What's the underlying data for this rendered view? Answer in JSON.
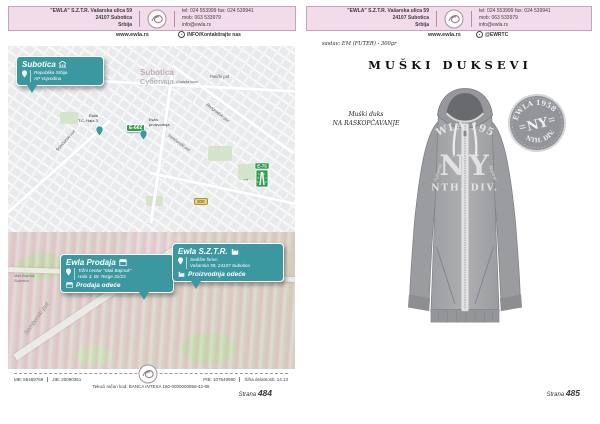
{
  "colors": {
    "header_pink": "#f3dcea",
    "card_teal": "#3b98a1",
    "route_green": "#2e9e4f",
    "route_yellow": "#ecd27a"
  },
  "header": {
    "company_line1": "\"EWLA\" S.Z.T.R. Vašarska ulica 59",
    "company_line2": "24107 Subotica",
    "company_line3": "Srbija",
    "contact_line1": "tel: 024 553999  fax: 024 539941",
    "contact_line2": "mob: 063 533979",
    "contact_line3": "info@ewla.rs",
    "website": "www.ewla.rs",
    "info_link": "INFO/Kontaktirajte nas",
    "social_handle": "@EWRTC"
  },
  "map": {
    "city_card": {
      "title": "Subotica",
      "region_line1": "Republika Srbija",
      "region_line2": "AP Vojvodina"
    },
    "city_latin": "Subotica",
    "city_cyrillic": "Суботица",
    "poi_center": "Gradska kuća",
    "road_palicki": "Palićki put",
    "road_beogradski": "Beogradski put",
    "road_sencanski": "Senćanski put",
    "road_somborski": "Somborski put",
    "badge_e662": "E-662",
    "badge_300": "300",
    "badge_e75": "E-75",
    "marker_prod_line1": "Ewla",
    "marker_prod_line2": "T.C. Hala 3",
    "marker_factory_line1": "Ewla",
    "marker_factory_line2": "proizvodnja",
    "district_line1": "Mali Bajmok",
    "district_line2": "Subotica",
    "aerial_road": "Somborski put"
  },
  "cards": {
    "prodaja": {
      "title": "Ewla Prodaja",
      "addr_line1": "Tržni centar \"Mali Bajmok\"",
      "addr_line2": "Hala 3, Bc Tezge 31/23",
      "tag": "Prodaja odeće"
    },
    "sztr": {
      "title": "Ewla S.Z.T.R.",
      "addr_line1": "Sedište firme:",
      "addr_line2": "Vašarska 59, 24107 Subotica",
      "tag": "Proizvodnja odeće"
    }
  },
  "footer": {
    "mb": "MB: 55469769",
    "jib": "JIB: 20090351",
    "pib": "PIB: 107549990",
    "activity": "Šifra delatnosti: 14.13",
    "bank_account": "Tekući račun kod: BANCA INTESA 160-0000000956-42-86",
    "page_word": "Strana",
    "left_page_number": "484",
    "right_page_number": "485"
  },
  "product": {
    "material_note": "sastav: EM (FUTER) - 300gr",
    "title": "MUŠKI DUKSEVI",
    "label_line1": "Muški duks",
    "label_line2": "NA RASKOPČAVANJE",
    "print_arc": "EWLA 1958",
    "print_left": "N",
    "print_right": "Y",
    "print_script_left": "Authentic",
    "print_script_right": "Apparel",
    "print_bottom": "NTH. DIV.",
    "badge_arc_top": "EWLA 1958",
    "badge_center": "NY",
    "badge_arc_bottom": "NTH. DIV."
  }
}
